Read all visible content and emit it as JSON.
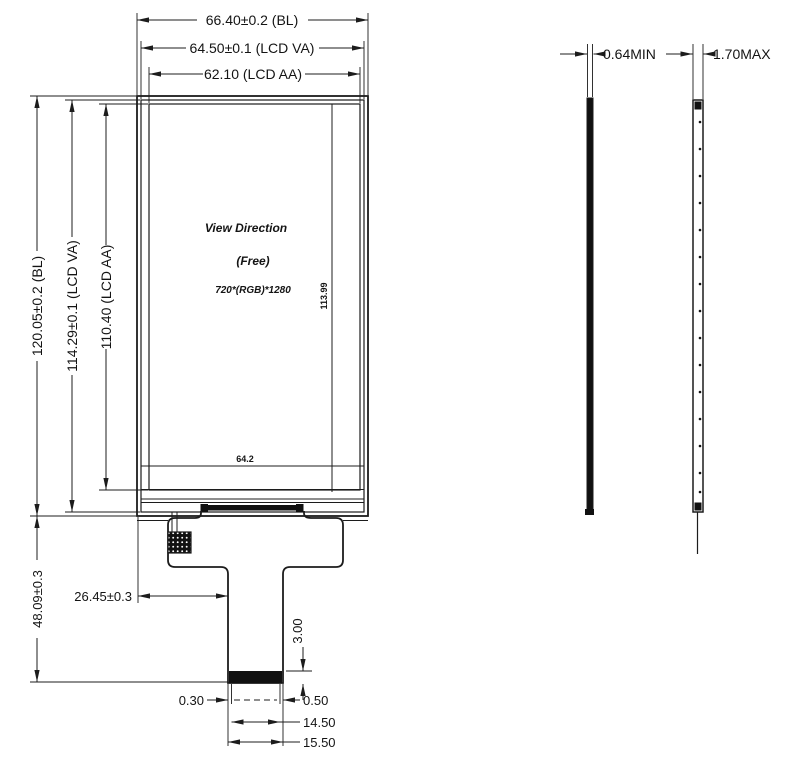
{
  "front_view": {
    "width_dims": {
      "bl": "66.40±0.2 (BL)",
      "va": "64.50±0.1 (LCD VA)",
      "aa": "62.10 (LCD AA)"
    },
    "height_dims": {
      "bl": "120.05±0.2 (BL)",
      "va": "114.29±0.1 (LCD VA)",
      "aa": "110.40 (LCD AA)"
    },
    "screen": {
      "view_direction": "View Direction",
      "mode": "(Free)",
      "resolution": "720*(RGB)*1280",
      "inner_height": "113.99",
      "inner_width": "64.2"
    }
  },
  "fpc": {
    "module_height": "48.09±0.3",
    "tail_offset": "26.45±0.3",
    "contact_length": "3.00",
    "left_margin": "0.30",
    "right_margin": "0.50",
    "contact_width": "14.50",
    "tail_width": "15.50"
  },
  "side_views": {
    "min_thickness": "0.64MIN",
    "max_thickness": "1.70MAX"
  },
  "colors": {
    "line": "#1c1c1c",
    "background": "#ffffff",
    "fill_black": "#111111"
  }
}
